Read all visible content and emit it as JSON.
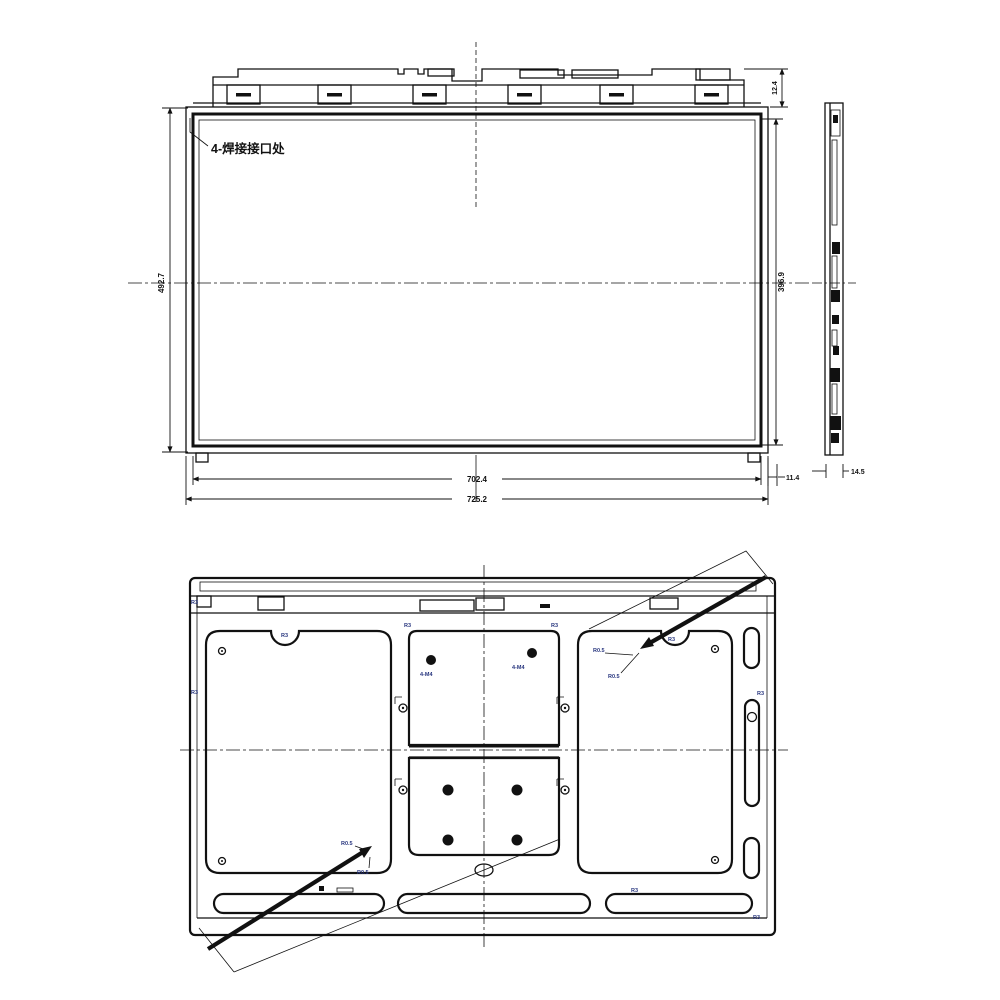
{
  "drawing": {
    "front_view": {
      "weld_note": "4-焊接接口处",
      "dim_height": "492.7",
      "dim_active_height": "396.9",
      "dim_top_offset": "12.4",
      "dim_inner_width": "702.4",
      "dim_outer_width": "725.2",
      "dim_side_offset": "11.4"
    },
    "side_view": {
      "dim_thickness": "14.5"
    },
    "rear_view": {
      "mount_hole_label": "4-M4",
      "corner_radius_label": "R3",
      "edge_radius_label": "R0.5"
    }
  }
}
